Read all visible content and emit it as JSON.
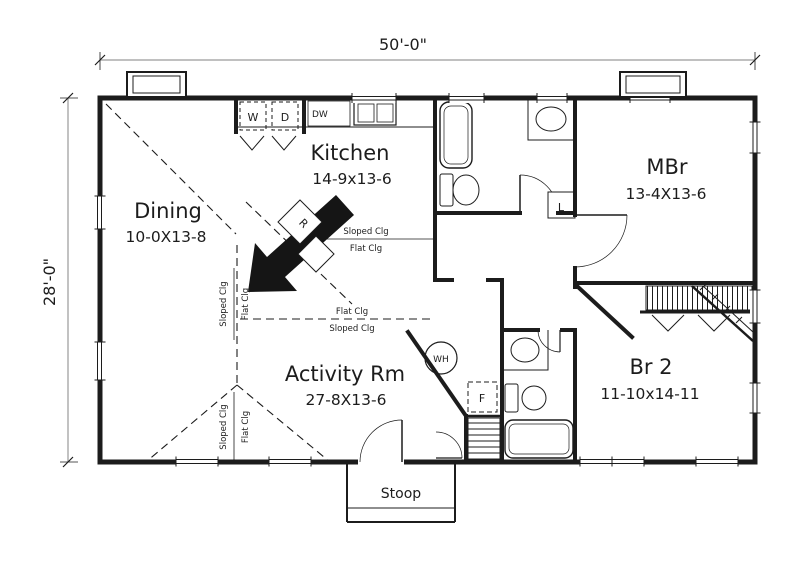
{
  "dimensions": {
    "width_label": "50'-0\"",
    "height_label": "28'-0\""
  },
  "rooms": [
    {
      "name": "Dining",
      "size": "10-0X13-8"
    },
    {
      "name": "Kitchen",
      "size": "14-9x13-6"
    },
    {
      "name": "MBr",
      "size": "13-4X13-6"
    },
    {
      "name": "Activity Rm",
      "size": "27-8X13-6"
    },
    {
      "name": "Br 2",
      "size": "11-10x14-11"
    }
  ],
  "stoop": {
    "label": "Stoop"
  },
  "ceiling": {
    "sloped": "Sloped Clg",
    "flat": "Flat Clg"
  },
  "fixtures": {
    "washer": "W",
    "dryer": "D",
    "dishwasher": "DW",
    "range": "R",
    "water_heater": "WH",
    "furnace": "F",
    "linen": "L"
  },
  "colors": {
    "line": "#1c1c1c",
    "background": "#ffffff"
  }
}
